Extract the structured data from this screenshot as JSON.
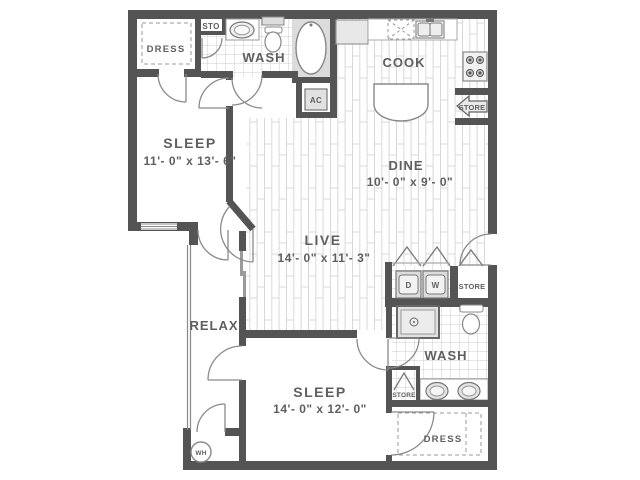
{
  "plan": {
    "rooms": {
      "sleep1": {
        "label": "SLEEP",
        "dims": "11'- 0\" x 13'- 6\""
      },
      "live": {
        "label": "LIVE",
        "dims": "14'- 0\" x 11'- 3\""
      },
      "dine": {
        "label": "DINE",
        "dims": "10'- 0\" x 9'- 0\""
      },
      "sleep2": {
        "label": "SLEEP",
        "dims": "14'- 0\" x 12'- 0\""
      },
      "cook": {
        "label": "COOK"
      },
      "wash_upper": {
        "label": "WASH"
      },
      "wash_lower": {
        "label": "WASH"
      },
      "relax": {
        "label": "RELAX"
      },
      "dress_upper": {
        "label": "DRESS"
      },
      "dress_lower": {
        "label": "DRESS"
      }
    },
    "fixtures": {
      "sto": {
        "label": "STO"
      },
      "ac": {
        "label": "AC"
      },
      "pantry_store": {
        "label": "STORE"
      },
      "hall_store": {
        "label": "STORE"
      },
      "bath_store": {
        "label": "STORE"
      },
      "dryer": {
        "label": "D"
      },
      "washer": {
        "label": "W"
      },
      "water_heater": {
        "label": "WH"
      }
    },
    "colors": {
      "wall": "#545454",
      "text": "#5f5f5f",
      "fixture_fill": "#dcdcdc",
      "tile_line": "#cccccc",
      "plank_line": "#d8d8d8",
      "door_arc": "#8a8a8a",
      "background": "#ffffff"
    }
  }
}
